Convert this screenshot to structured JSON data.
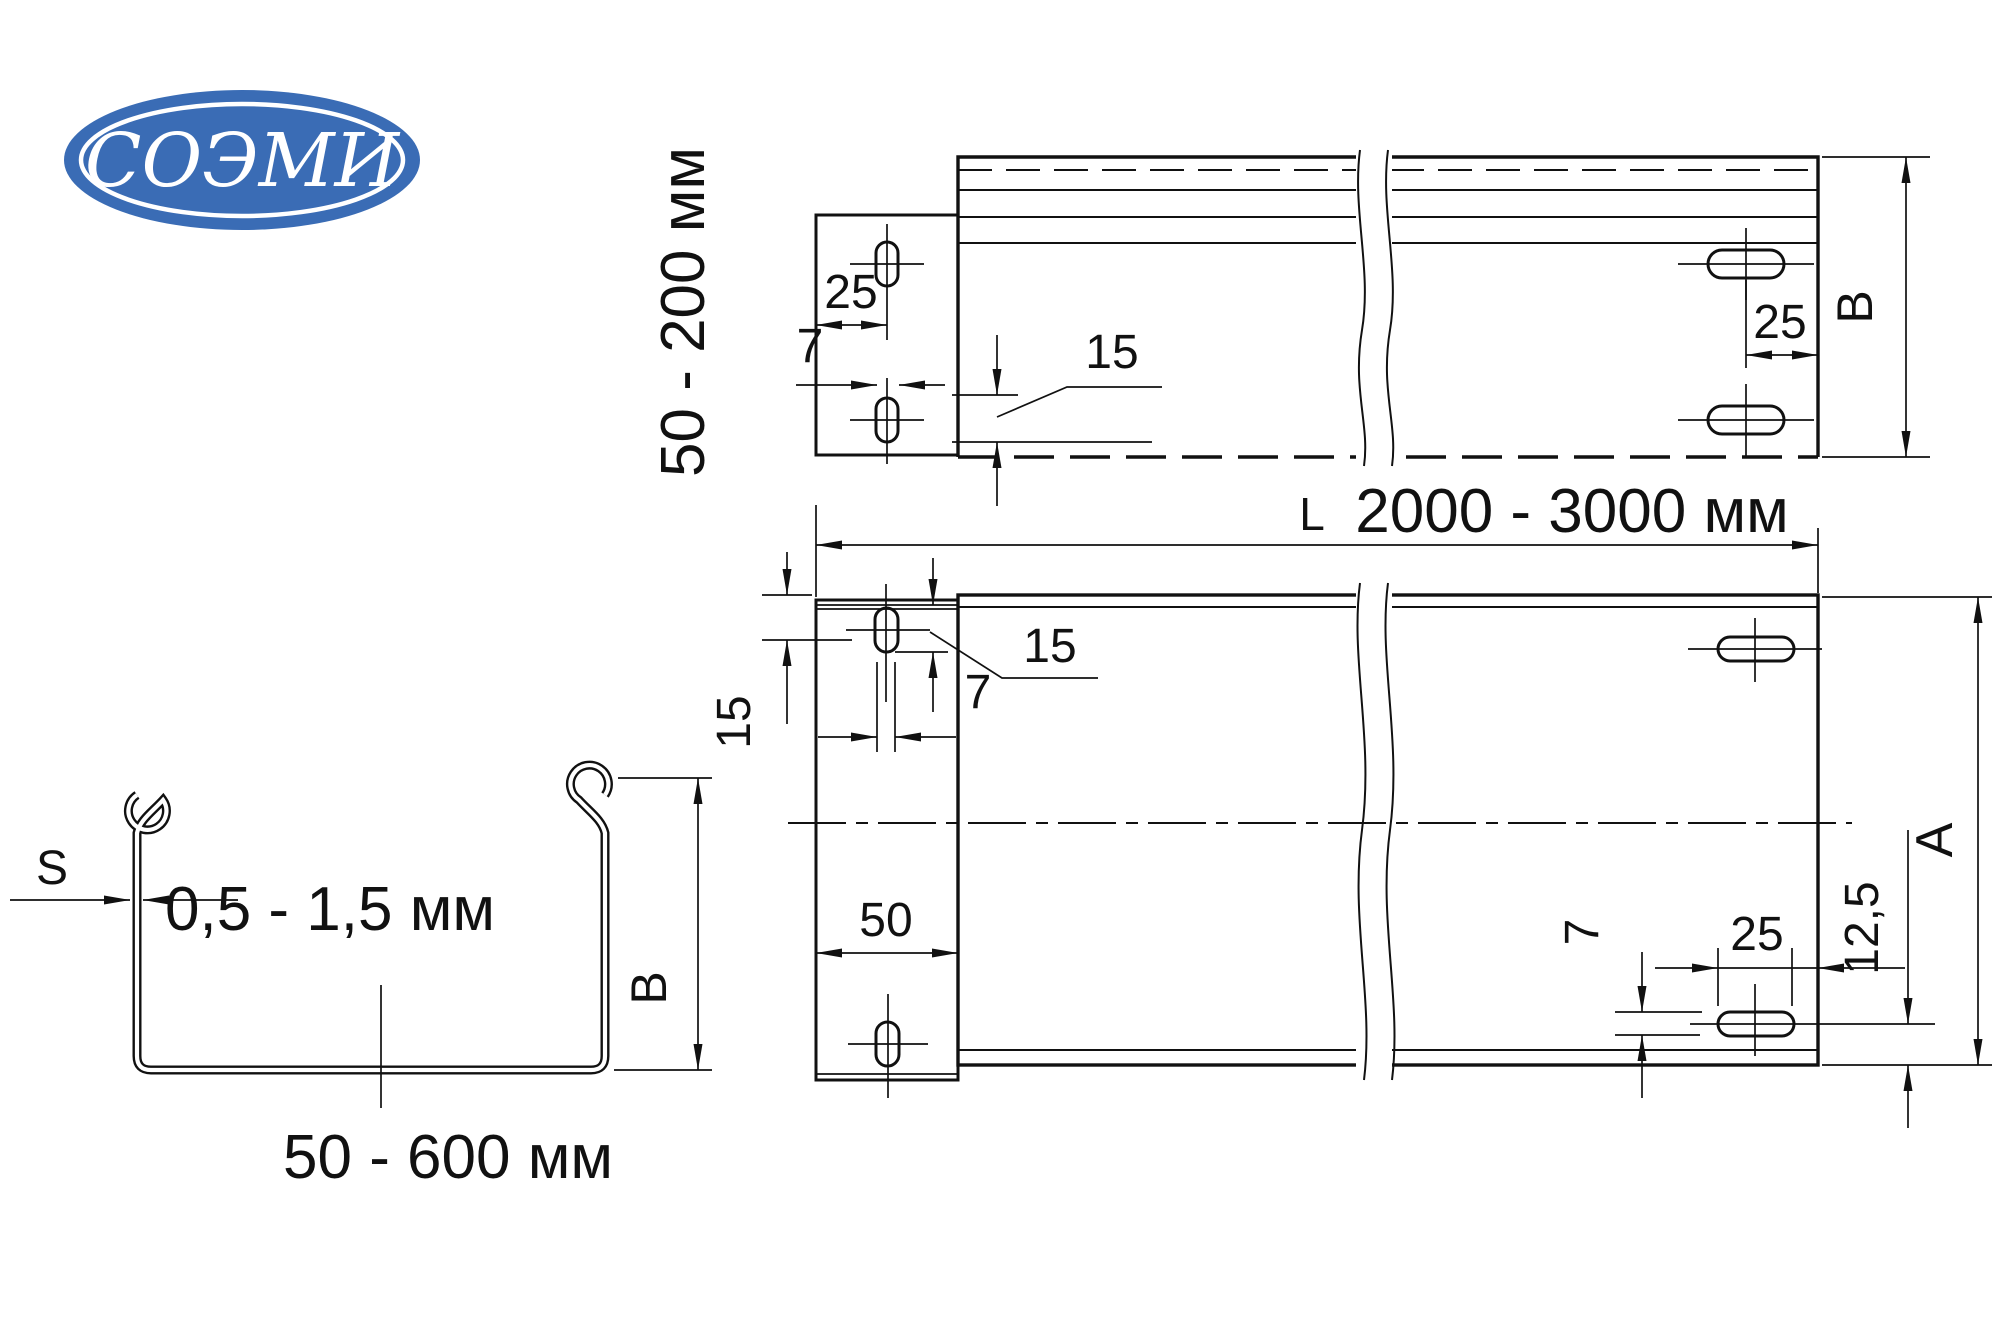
{
  "logo": {
    "text": "СОЭМИ",
    "bg_color": "#3a6cb5"
  },
  "side_view": {
    "height_range": "50 - 200 мм",
    "dim_edge_to_slot": "25",
    "dim_slot_width": "7",
    "dim_flange": "15",
    "dim_slot_to_end": "25",
    "dim_width": "В"
  },
  "plan_view": {
    "length_prefix": "L",
    "length_range": "2000 - 3000 мм",
    "dim_top_offset": "15",
    "dim_slot_width_top": "7",
    "dim_overlap": "15",
    "dim_tab_width": "50",
    "dim_slot_width_bottom": "7",
    "dim_slot_to_end": "25",
    "dim_slot_offset": "12,5",
    "dim_height": "А"
  },
  "section_view": {
    "thickness_symbol": "S",
    "thickness_range": "0,5 - 1,5 мм",
    "width_range": "50 - 600 мм",
    "dim_height": "В"
  }
}
